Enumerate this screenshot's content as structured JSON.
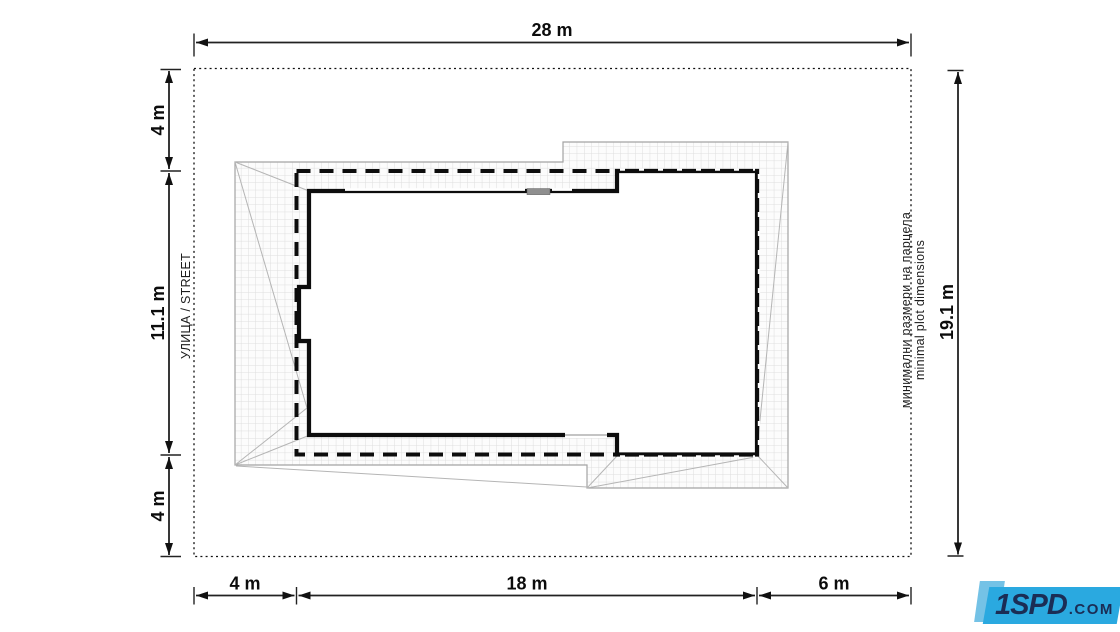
{
  "dimensions": {
    "top": "28 m",
    "right": "19.1 m",
    "left": [
      "4 m",
      "11.1 m",
      "4 m"
    ],
    "bottom": [
      "4 m",
      "18 m",
      "6 m"
    ]
  },
  "labels": {
    "street": "УЛИЦА / STREET",
    "note_bg": "минимални размери на парцела",
    "note_en": "minimal plot dimensions"
  },
  "logo": {
    "brand": "1SPD",
    "suffix": ".COM"
  },
  "colors": {
    "dimension_lines": "#222222",
    "plot_boundary": "#111111",
    "building_envelope": "#0d0d0d",
    "house_walls": "#0d0d0d",
    "roof_grid": "#dedede",
    "roof_outline": "#a3a3a3",
    "logo_front": "#2aa9e0",
    "logo_back": "#74c2e6",
    "logo_text": "#1b2d55"
  }
}
